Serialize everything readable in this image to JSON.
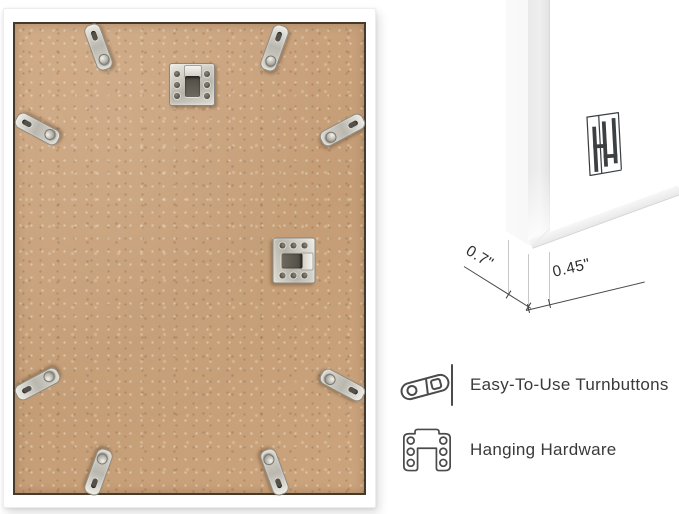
{
  "product_image": {
    "type": "picture-frame-back-infographic",
    "background": "#ffffff"
  },
  "frame_back": {
    "frame_color": "#ffffff",
    "board_color": "#c9a47e",
    "hardware_color": "#c9c7bd",
    "turnbutton_count": 8,
    "hanging_bracket_count": 2
  },
  "corner_detail": {
    "logo": "hh-brand-logo",
    "depth_dimension": "0.7\"",
    "face_width_dimension": "0.45\""
  },
  "features": [
    {
      "icon": "turnbutton-icon",
      "label": "Easy-To-Use Turnbuttons"
    },
    {
      "icon": "hanging-hardware-icon",
      "label": "Hanging Hardware"
    }
  ]
}
